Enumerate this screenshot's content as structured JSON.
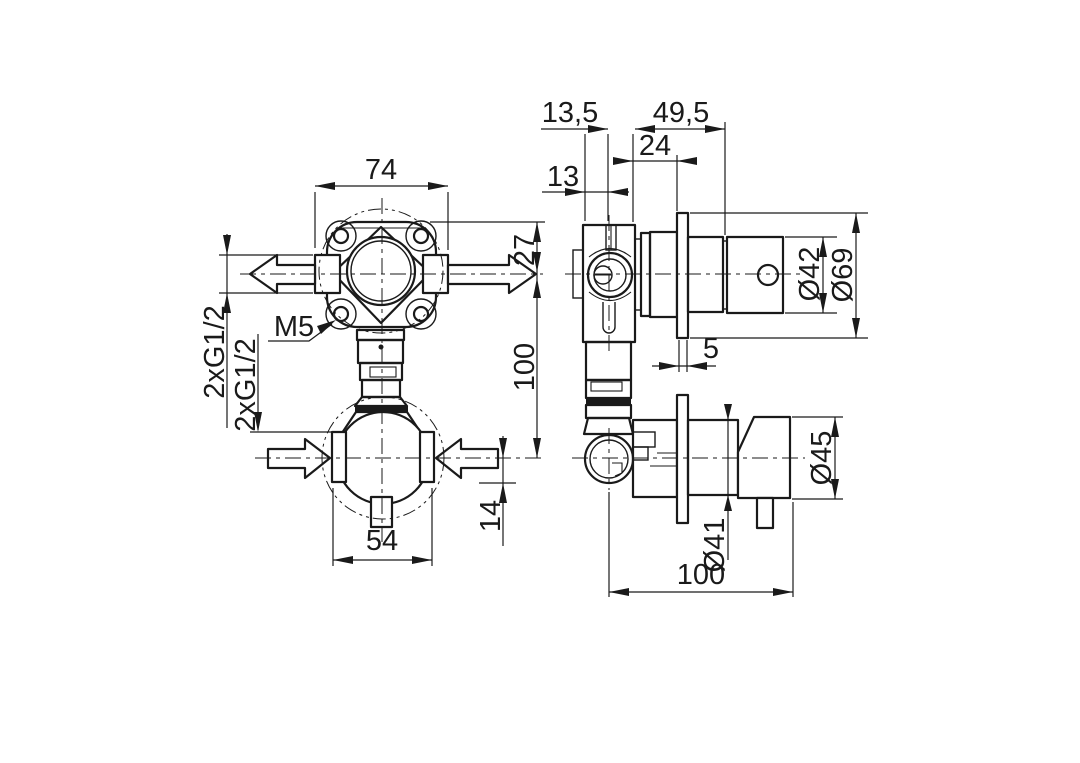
{
  "drawing": {
    "background": "#ffffff",
    "ink": "#1a1a1a",
    "front_view": {
      "dims": {
        "flange_width": "74",
        "top_offset": "27",
        "port_spacing": "100",
        "inlet_offset": "14",
        "body_width": "54",
        "screw_thread": "M5",
        "outlet_thread": "2xG1/2",
        "inlet_thread": "2xG1/2"
      }
    },
    "side_view": {
      "dims": {
        "axis_to_face": "13,5",
        "body_to_plate_end": "49,5",
        "body_to_wall": "24",
        "face_to_axis": "13",
        "plate_thickness": "5",
        "cap_diameter": "Ø42",
        "plate_diameter": "Ø69",
        "handle_diameter": "Ø45",
        "body_diameter": "Ø41",
        "overall_depth": "100"
      }
    }
  }
}
